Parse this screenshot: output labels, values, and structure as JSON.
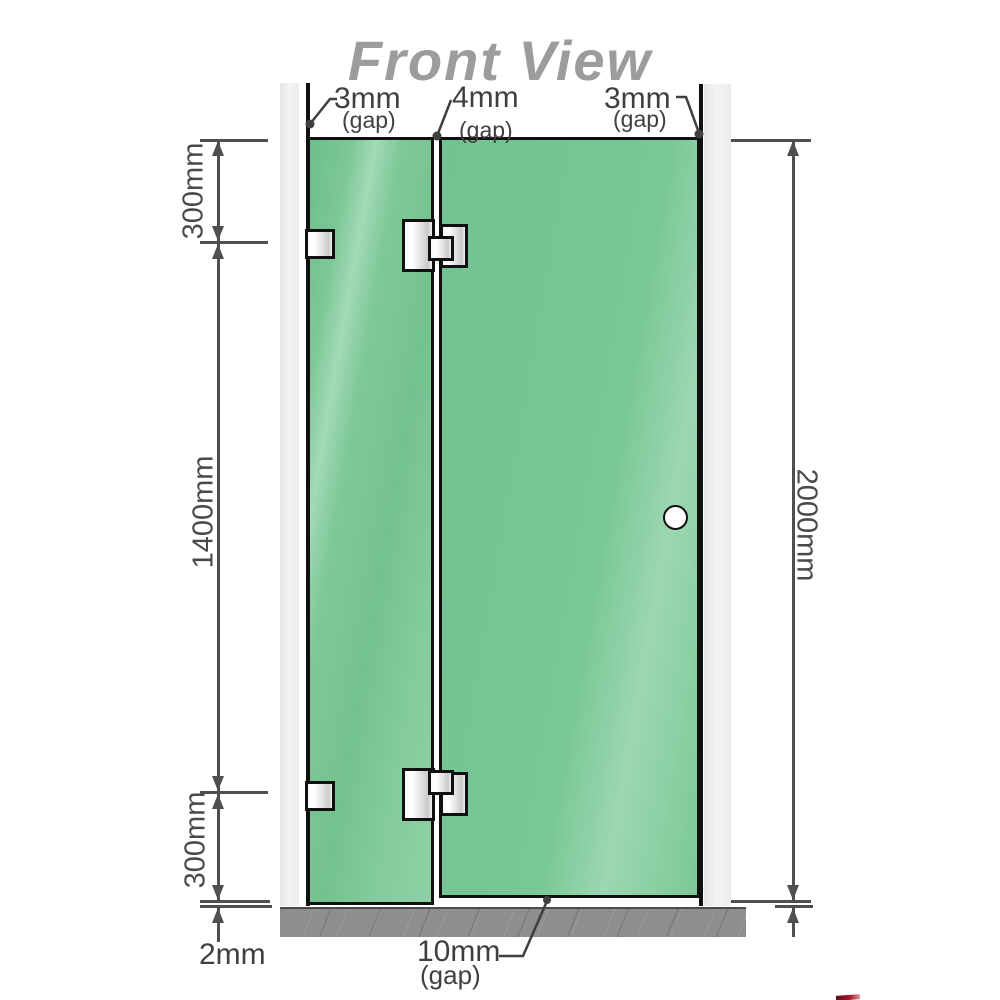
{
  "title": "Front View",
  "gaps": {
    "top_left": {
      "value": "3mm",
      "label": "(gap)"
    },
    "top_middle": {
      "value": "4mm",
      "label": "(gap)"
    },
    "top_right": {
      "value": "3mm",
      "label": "(gap)"
    },
    "bottom": {
      "value": "10mm",
      "label": "(gap)"
    }
  },
  "dimensions": {
    "left_top": "300mm",
    "left_middle": "1400mm",
    "left_bottom": "300mm",
    "right": "2000mm",
    "bottom_left": "2mm"
  },
  "colors": {
    "glass": "#7cc795",
    "glass_highlight": "#9cd7b1",
    "wall": "#ededed",
    "floor": "#8e8e8e",
    "outline": "#101010",
    "dimension": "#4f4f4f",
    "title": "#9c9c9c",
    "accent_red": "#a61b29"
  }
}
